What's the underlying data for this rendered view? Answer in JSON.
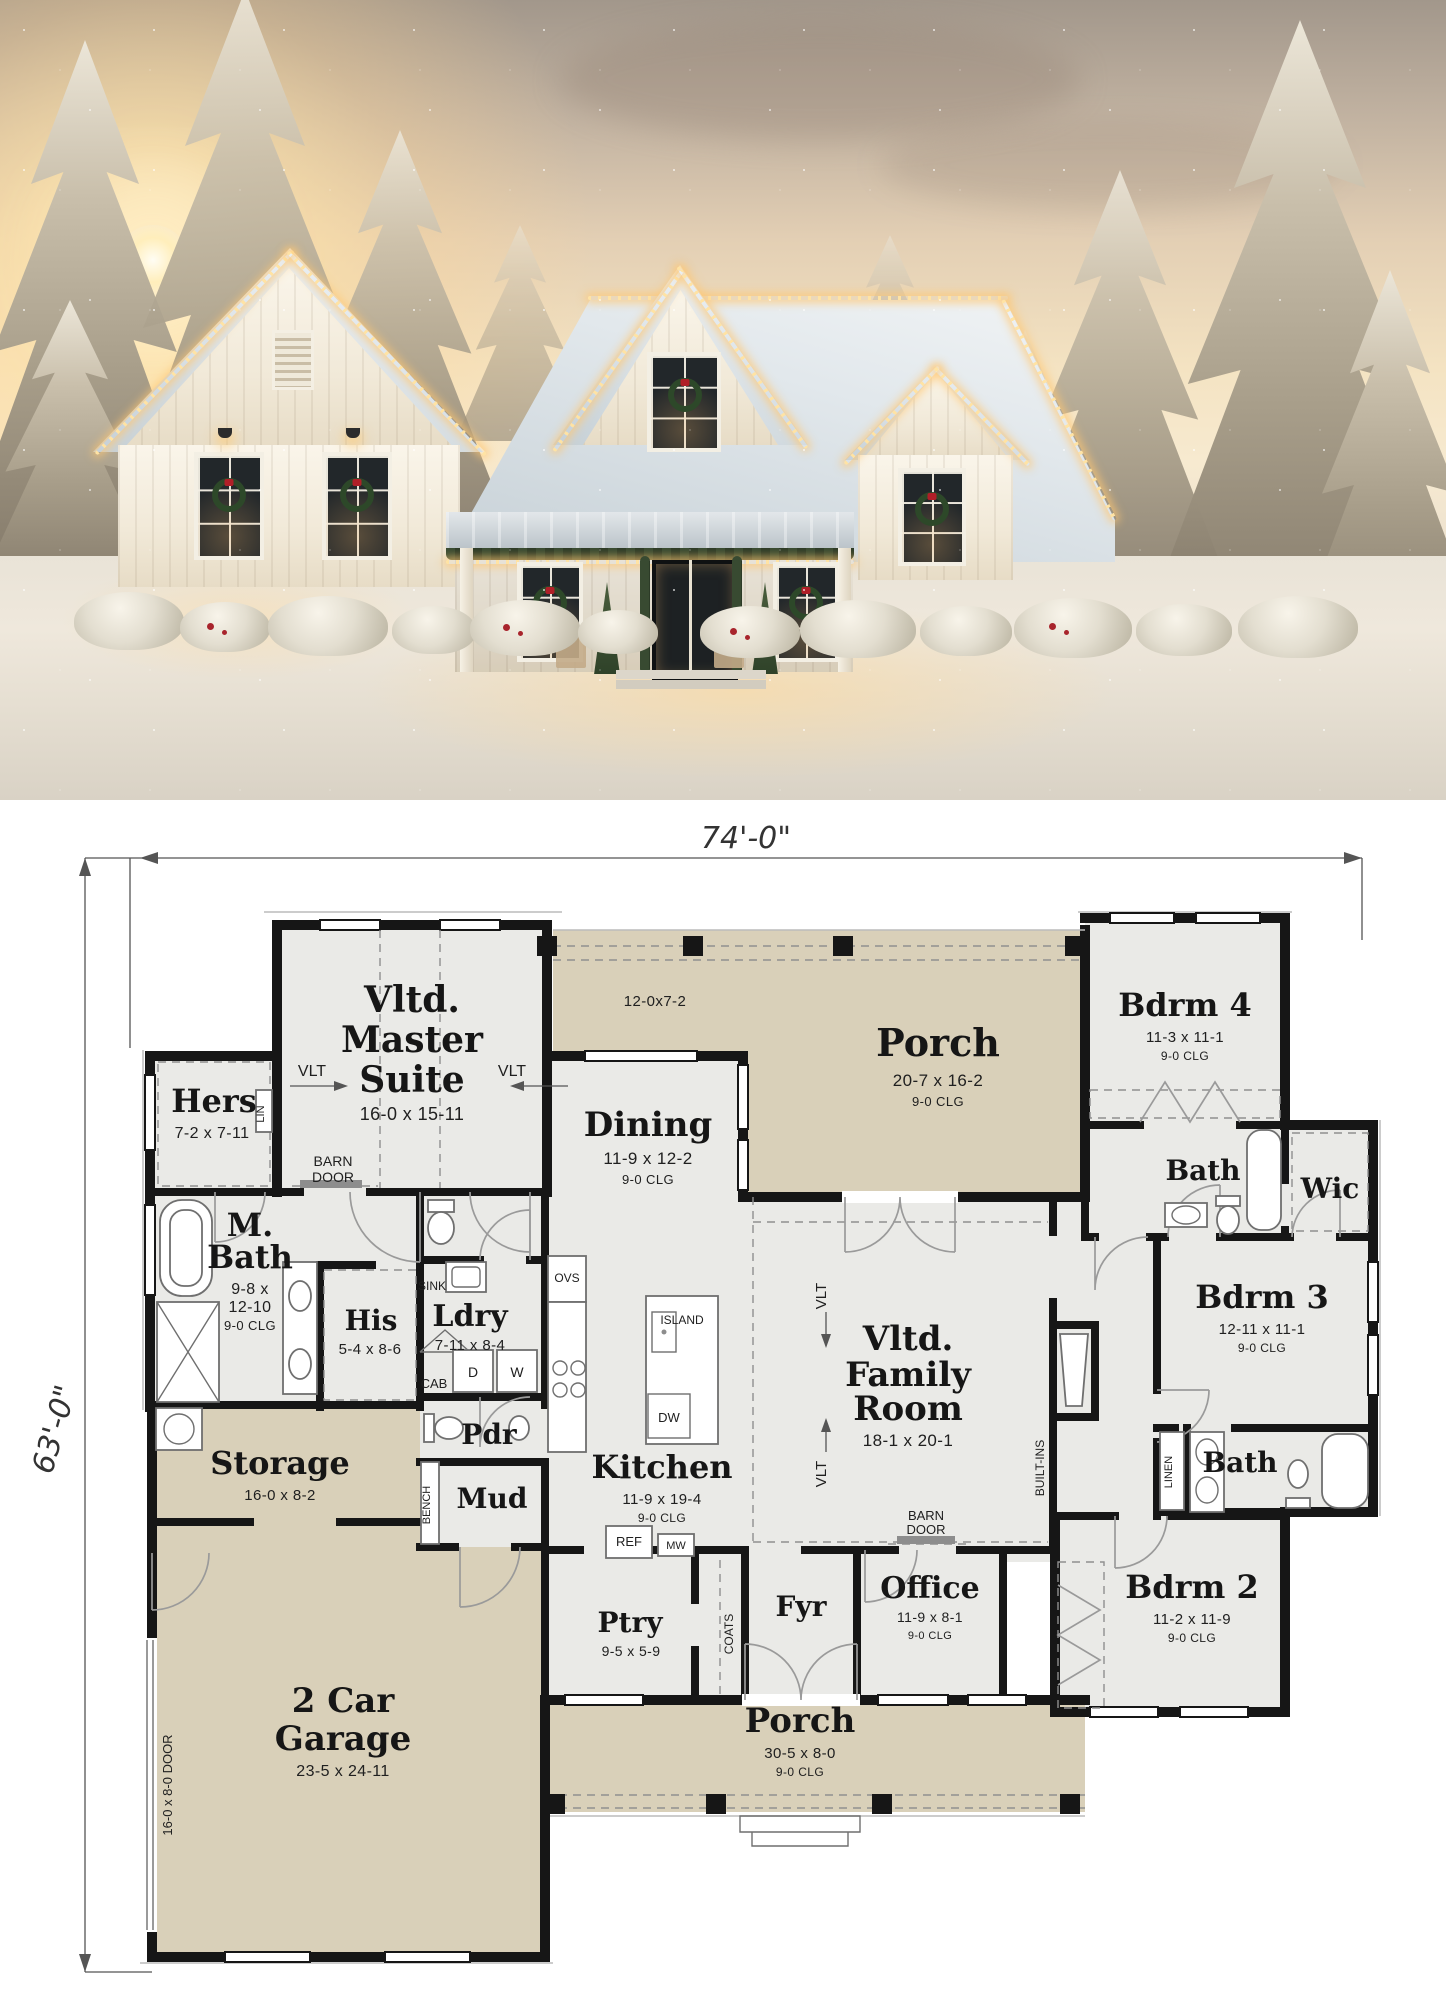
{
  "plan": {
    "dim_width": "74'-0\"",
    "dim_height": "63'-0\"",
    "rooms": {
      "master": {
        "l1": "Vltd.",
        "l2": "Master",
        "l3": "Suite",
        "dims": "16-0 x 15-11"
      },
      "hers": {
        "name": "Hers",
        "dims": "7-2 x 7-11"
      },
      "mbath": {
        "l1": "M.",
        "l2": "Bath",
        "d1": "9-8 x",
        "d2": "12-10",
        "clg": "9-0 CLG"
      },
      "his": {
        "name": "His",
        "dims": "5-4 x 8-6"
      },
      "ldry": {
        "name": "Ldry",
        "dims": "7-11 x 8-4"
      },
      "dining": {
        "name": "Dining",
        "dims": "11-9 x 12-2",
        "clg": "9-0 CLG"
      },
      "porch_top": {
        "name": "Porch",
        "dims": "20-7 x 16-2",
        "clg": "9-0 CLG",
        "wing": "12-0x7-2"
      },
      "bdrm4": {
        "name": "Bdrm 4",
        "dims": "11-3 x 11-1",
        "clg": "9-0 CLG"
      },
      "bath_top": {
        "name": "Bath"
      },
      "wic": {
        "name": "Wic"
      },
      "bdrm3": {
        "name": "Bdrm 3",
        "dims": "12-11 x 11-1",
        "clg": "9-0 CLG"
      },
      "family": {
        "l1": "Vltd.",
        "l2": "Family",
        "l3": "Room",
        "dims": "18-1 x 20-1"
      },
      "kitchen": {
        "name": "Kitchen",
        "dims": "11-9 x 19-4",
        "clg": "9-0 CLG"
      },
      "pdr": {
        "name": "Pdr"
      },
      "mud": {
        "name": "Mud"
      },
      "storage": {
        "name": "Storage",
        "dims": "16-0 x 8-2"
      },
      "garage": {
        "l1": "2 Car",
        "l2": "Garage",
        "dims": "23-5 x 24-11",
        "door": "16-0 x 8-0 DOOR"
      },
      "ptry": {
        "name": "Ptry",
        "dims": "9-5 x 5-9"
      },
      "fyr": {
        "name": "Fyr"
      },
      "office": {
        "name": "Office",
        "dims": "11-9 x 8-1",
        "clg": "9-0 CLG"
      },
      "bdrm2": {
        "name": "Bdrm 2",
        "dims": "11-2 x 11-9",
        "clg": "9-0 CLG"
      },
      "bath_lower": {
        "name": "Bath"
      },
      "porch_bottom": {
        "name": "Porch",
        "dims": "30-5 x 8-0",
        "clg": "9-0 CLG"
      }
    },
    "labels": {
      "vlt": "VLT",
      "barn": "BARN",
      "door": "DOOR",
      "lin": "LIN",
      "sink": "SINK",
      "cab": "CAB",
      "dryer": "D",
      "washer": "W",
      "ovs": "OVS",
      "island": "ISLAND",
      "dw": "DW",
      "ref": "REF",
      "mw": "MW",
      "bench": "BENCH",
      "coats": "COATS",
      "built_ins": "BUILT-INS",
      "linen": "LINEN"
    },
    "colors": {
      "porch_fill": "#d9d0b9",
      "room_fill": "#eaeae7",
      "wall": "#161616",
      "accent_wreath": "#2d4829",
      "accent_bow": "#b01f28"
    }
  }
}
